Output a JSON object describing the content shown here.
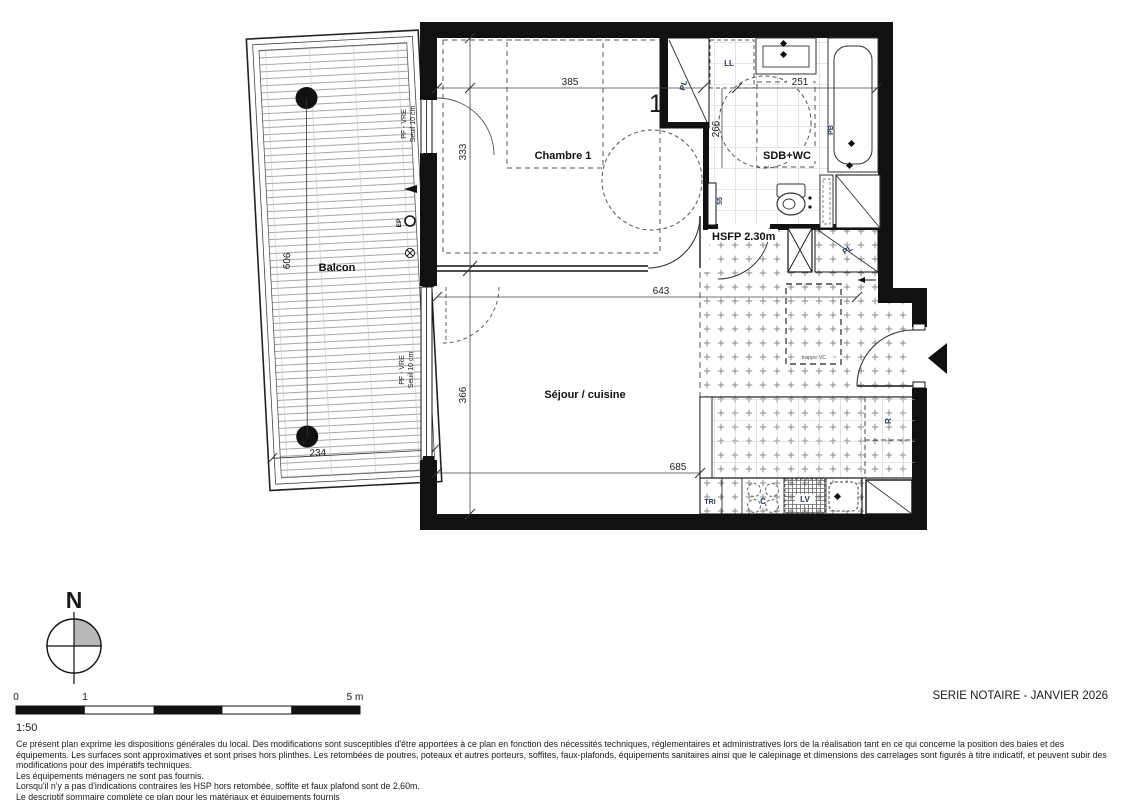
{
  "plan": {
    "rooms": {
      "chambre": "Chambre 1",
      "sdb": "SDB+WC",
      "sejour": "Séjour / cuisine",
      "balcon": "Balcon",
      "hsfp": "HSFP 2.30m"
    },
    "dims": {
      "d385": "385",
      "d333": "333",
      "d643": "643",
      "d366": "366",
      "d685": "685",
      "d606": "606",
      "d234": "234",
      "d251": "251",
      "d266": "266",
      "d55": "55"
    },
    "equip": {
      "pl": "PL",
      "ll": "LL",
      "pb": "PB",
      "r": "R",
      "c": "C",
      "lv": "LV",
      "tri": "TRI",
      "ep": "EP",
      "trappe": "trappe VC",
      "door_number": "1"
    },
    "windows": {
      "line1": "PF - VRE",
      "line2": "Seuil 10 cm"
    }
  },
  "compass": {
    "label": "N"
  },
  "scale": {
    "t0": "0",
    "t1": "1",
    "t5": "5 m",
    "ratio": "1:50"
  },
  "titleblock": {
    "series": "SERIE NOTAIRE - JANVIER 2026"
  },
  "notes": {
    "p1": "Ce présent plan exprime les dispositions générales du local. Des modifications sont susceptibles d'être apportées à ce plan en fonction des nécessités techniques, réglementaires et administratives lors de la réalisation tant en ce qui concerne la position des baies et des équipements. Les surfaces sont approximatives et sont prises hors plinthes. Les retombées de poutres, poteaux et autres porteurs, soffites, faux-plafonds, équipements sanitaires ainsi que le calepinage et dimensions des carrelages sont figurés à titre indicatif, et peuvent subir des modifications pour des impératifs techniques.",
    "l2": "Les équipements ménagers ne sont pas fournis.",
    "l3": "Lorsqu'il n'y a pas d'indications contraires les HSP hors retombée, soffite et faux plafond sont de 2,60m.",
    "l4": "Le descriptif sommaire complète ce plan pour les matériaux et équipements fournis"
  },
  "colors": {
    "wall": "#111111",
    "tile": "#8a8a8a",
    "grid": "#cccccc",
    "line": "#333333"
  }
}
